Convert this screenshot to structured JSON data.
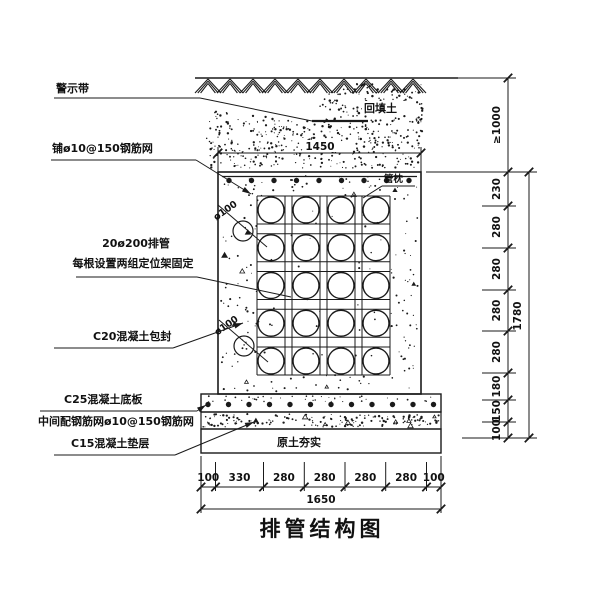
{
  "meta": {
    "title_text": "排管结构图"
  },
  "labels": {
    "warning_tape": "警示带",
    "top_mesh": "铺ø10@150钢筋网",
    "backfill": "回填土",
    "pipe_cradle": "管枕",
    "pipe_run": "20ø200排管",
    "pipe_fix": "每根设置两组定位架固定",
    "encasement": "C20混凝土包封",
    "base_slab": "C25混凝土底板",
    "mid_mesh": "中间配钢筋网ø10@150钢筋网",
    "cushion": "C15混凝土垫层",
    "compacted_soil": "原土夯实",
    "drain_top": "ø100",
    "drain_bottom": "ø100"
  },
  "dimensions": {
    "top_width": "1450",
    "bottom_segments": [
      "100",
      "330",
      "280",
      "280",
      "280",
      "280",
      "100"
    ],
    "bottom_total": "1650",
    "cover_depth": "≥1000",
    "right_segments": [
      "230",
      "280",
      "280",
      "280",
      "280",
      "180",
      "150",
      "100"
    ],
    "right_total": "1780"
  },
  "structure": {
    "pipe_grid": {
      "cols": 4,
      "rows": 5,
      "pipe_count": 20,
      "pipe_spec": "ø200"
    }
  },
  "colors": {
    "ink": "#1a1a1a",
    "paper": "#ffffff"
  }
}
